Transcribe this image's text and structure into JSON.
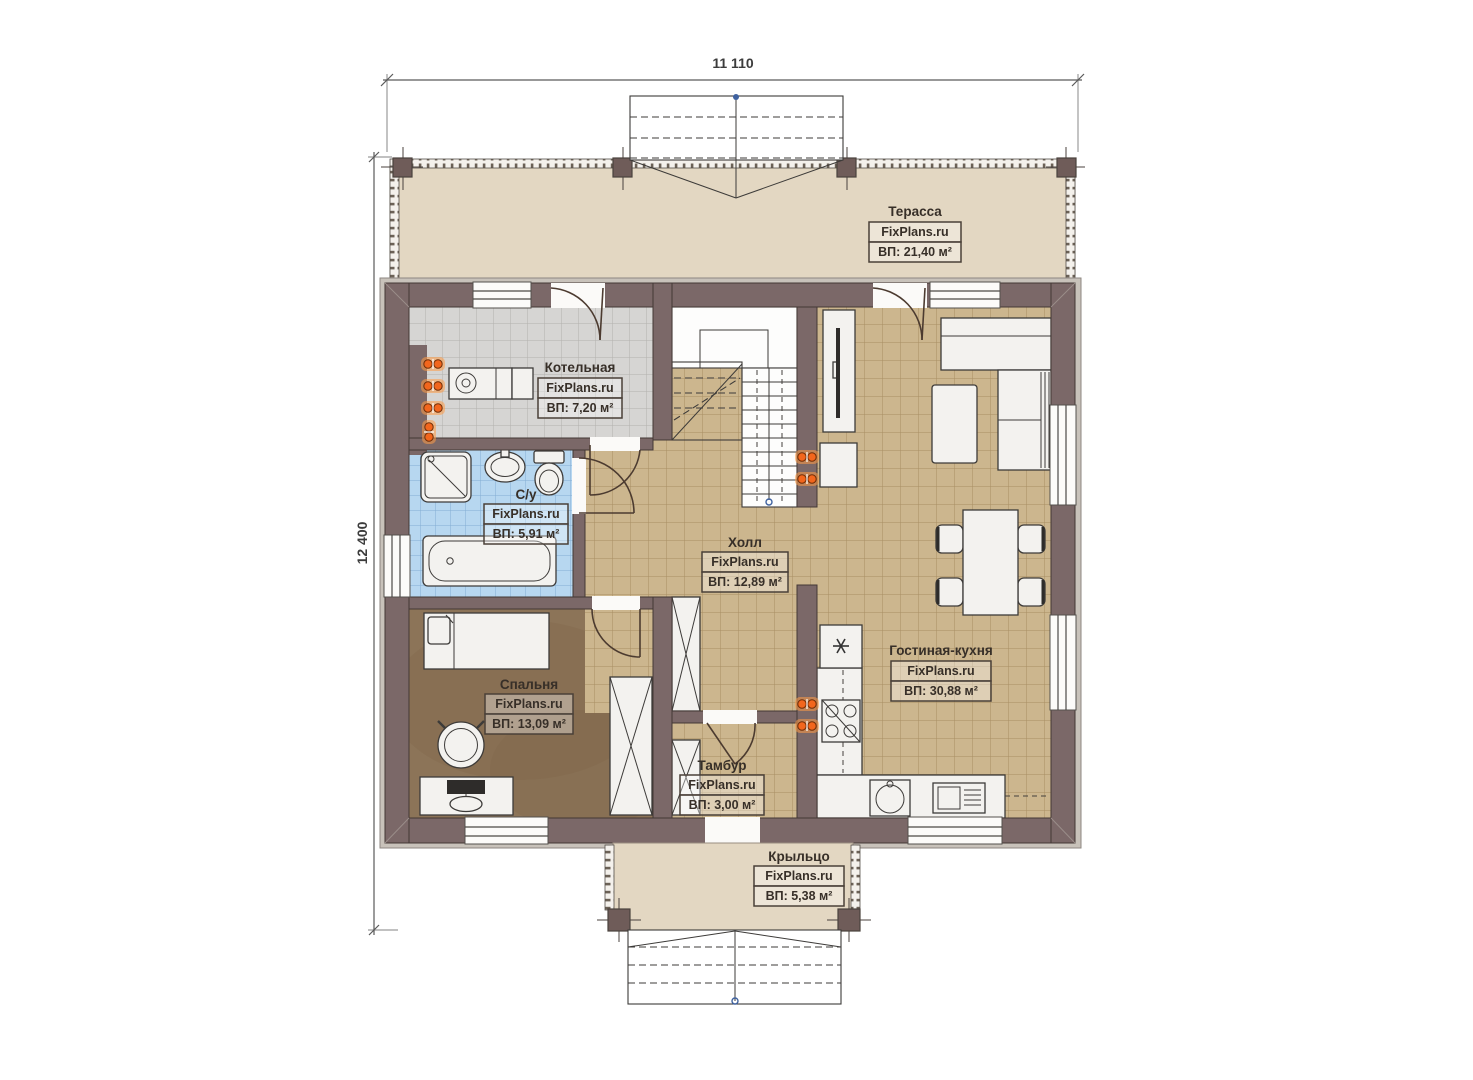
{
  "watermark": "FixPlans.ru",
  "dimensions": {
    "top": "11 110",
    "left": "12 400"
  },
  "rooms": {
    "terrace": {
      "name": "Терасса",
      "area": "ВП: 21,40 м²"
    },
    "boiler": {
      "name": "Котельная",
      "area": "ВП: 7,20 м²"
    },
    "bathroom": {
      "name": "С/у",
      "area": "ВП: 5,91 м²"
    },
    "hall": {
      "name": "Холл",
      "area": "ВП: 12,89 м²"
    },
    "living_kitchen": {
      "name": "Гостиная-кухня",
      "area": "ВП: 30,88 м²"
    },
    "bedroom": {
      "name": "Спальня",
      "area": "ВП: 13,09 м²"
    },
    "vestibule": {
      "name": "Тамбур",
      "area": "ВП: 3,00 м²"
    },
    "porch": {
      "name": "Крыльцо",
      "area": "ВП: 5,38 м²"
    }
  },
  "colors": {
    "wall": "#7b6868",
    "terrace_floor": "#e3d7c2",
    "tile_beige": "#ccb68e",
    "tile_gray": "#d6d5d3",
    "tile_blue": "#b7d7f0",
    "bedroom_floor": "#8c7458",
    "radiator_orange": "#f2661d"
  }
}
